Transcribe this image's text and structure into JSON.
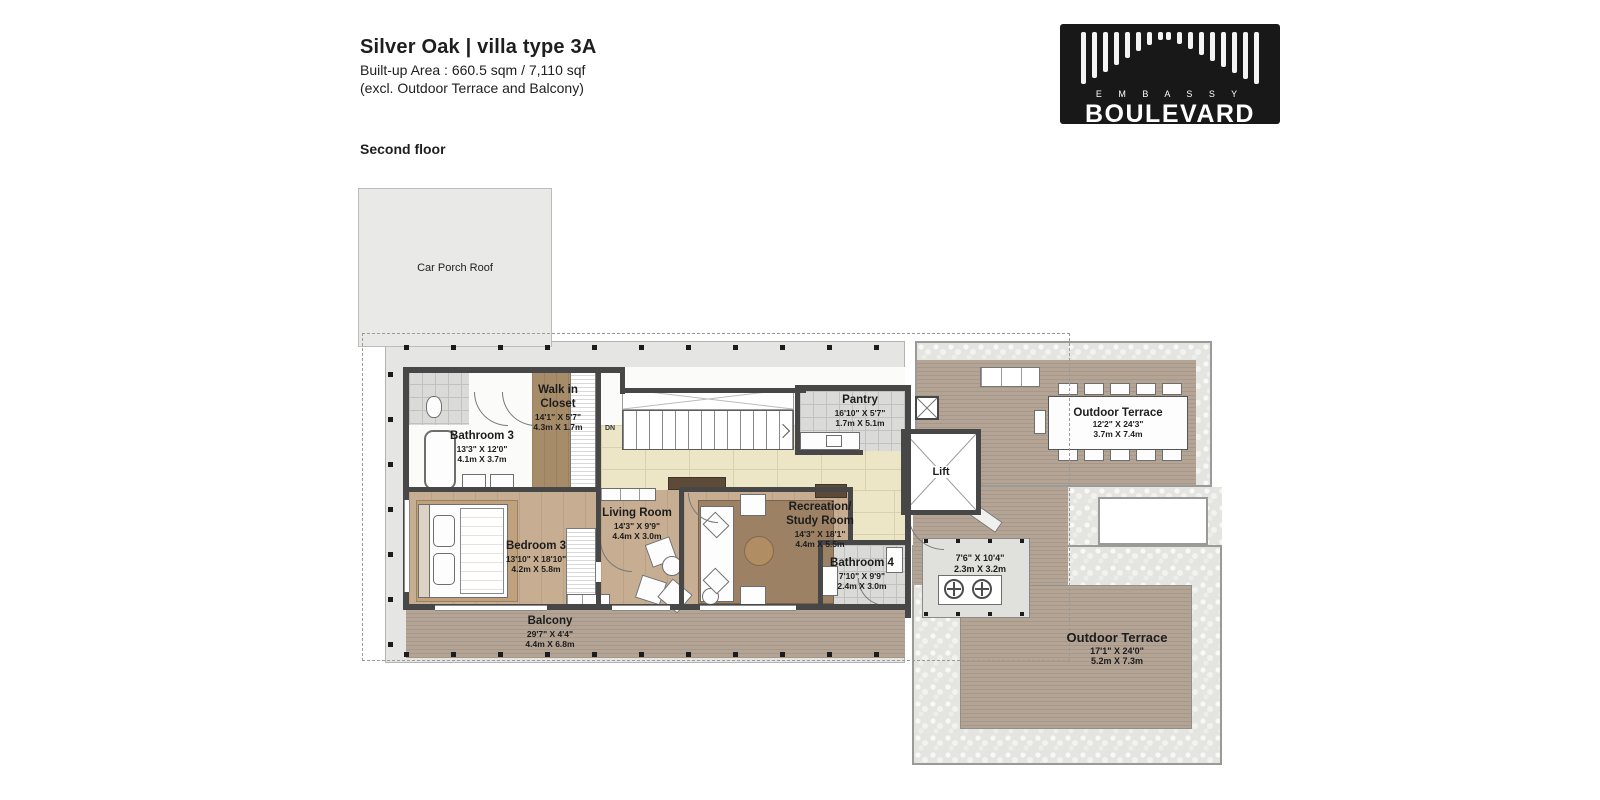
{
  "header": {
    "title": "Silver Oak | villa type 3A",
    "area_line": "Built-up Area : 660.5 sqm / 7,110 sqf",
    "excl_line": "(excl. Outdoor Terrace and Balcony)",
    "floor_label": "Second floor"
  },
  "logo": {
    "embassy": "E M B A S S Y",
    "boulevard": "BOULEVARD",
    "bar_groups": {
      "left": [
        52,
        46,
        40,
        33,
        26,
        19,
        13,
        8
      ],
      "right": [
        8,
        12,
        17,
        23,
        29,
        35,
        41,
        47,
        52
      ]
    }
  },
  "rooms": {
    "car_porch": {
      "name": "Car Porch Roof"
    },
    "walk_in_closet": {
      "name1": "Walk in",
      "name2": "Closet",
      "ft": "14'1\" X 5'7\"",
      "m": "4.3m X 1.7m"
    },
    "bathroom3": {
      "name": "Bathroom 3",
      "ft": "13'3\" X 12'0\"",
      "m": "4.1m X 3.7m"
    },
    "bedroom3": {
      "name": "Bedroom 3",
      "ft": "13'10\" X 18'10\"",
      "m": "4.2m X 5.8m"
    },
    "living": {
      "name": "Living Room",
      "ft": "14'3\" X 9'9\"",
      "m": "4.4m X 3.0m"
    },
    "recreation": {
      "name1": "Recreation/",
      "name2": "Study Room",
      "ft": "14'3\" X 18'1\"",
      "m": "4.4m X 5.5m"
    },
    "pantry": {
      "name": "Pantry",
      "ft": "16'10\" X 5'7\"",
      "m": "1.7m X 5.1m"
    },
    "lift": {
      "name": "Lift"
    },
    "bathroom4": {
      "name": "Bathroom 4",
      "ft": "7'10\" X 9'9\"",
      "m": "2.4m X 3.0m"
    },
    "ac_ledge": {
      "ft": "7'6\" X 10'4\"",
      "m": "2.3m X 3.2m"
    },
    "balcony": {
      "name": "Balcony",
      "ft": "29'7\" X 4'4\"",
      "m": "4.4m X 6.8m"
    },
    "terrace_top": {
      "name": "Outdoor Terrace",
      "ft": "12'2\" X 24'3\"",
      "m": "3.7m X 7.4m"
    },
    "terrace_bottom": {
      "name": "Outdoor Terrace",
      "ft": "17'1\" X 24'0\"",
      "m": "5.2m X 7.3m"
    },
    "stairs": {
      "label": "DN"
    }
  },
  "colors": {
    "wall": "#474747",
    "wood_floor": "#c7ae92",
    "deck": "#b0a092",
    "cream_tile": "#ece5c6",
    "gray_tile": "#dadad8",
    "pebble": "#e4e4e0",
    "eave": "#e5e5e3",
    "logo_bg": "#181818"
  }
}
